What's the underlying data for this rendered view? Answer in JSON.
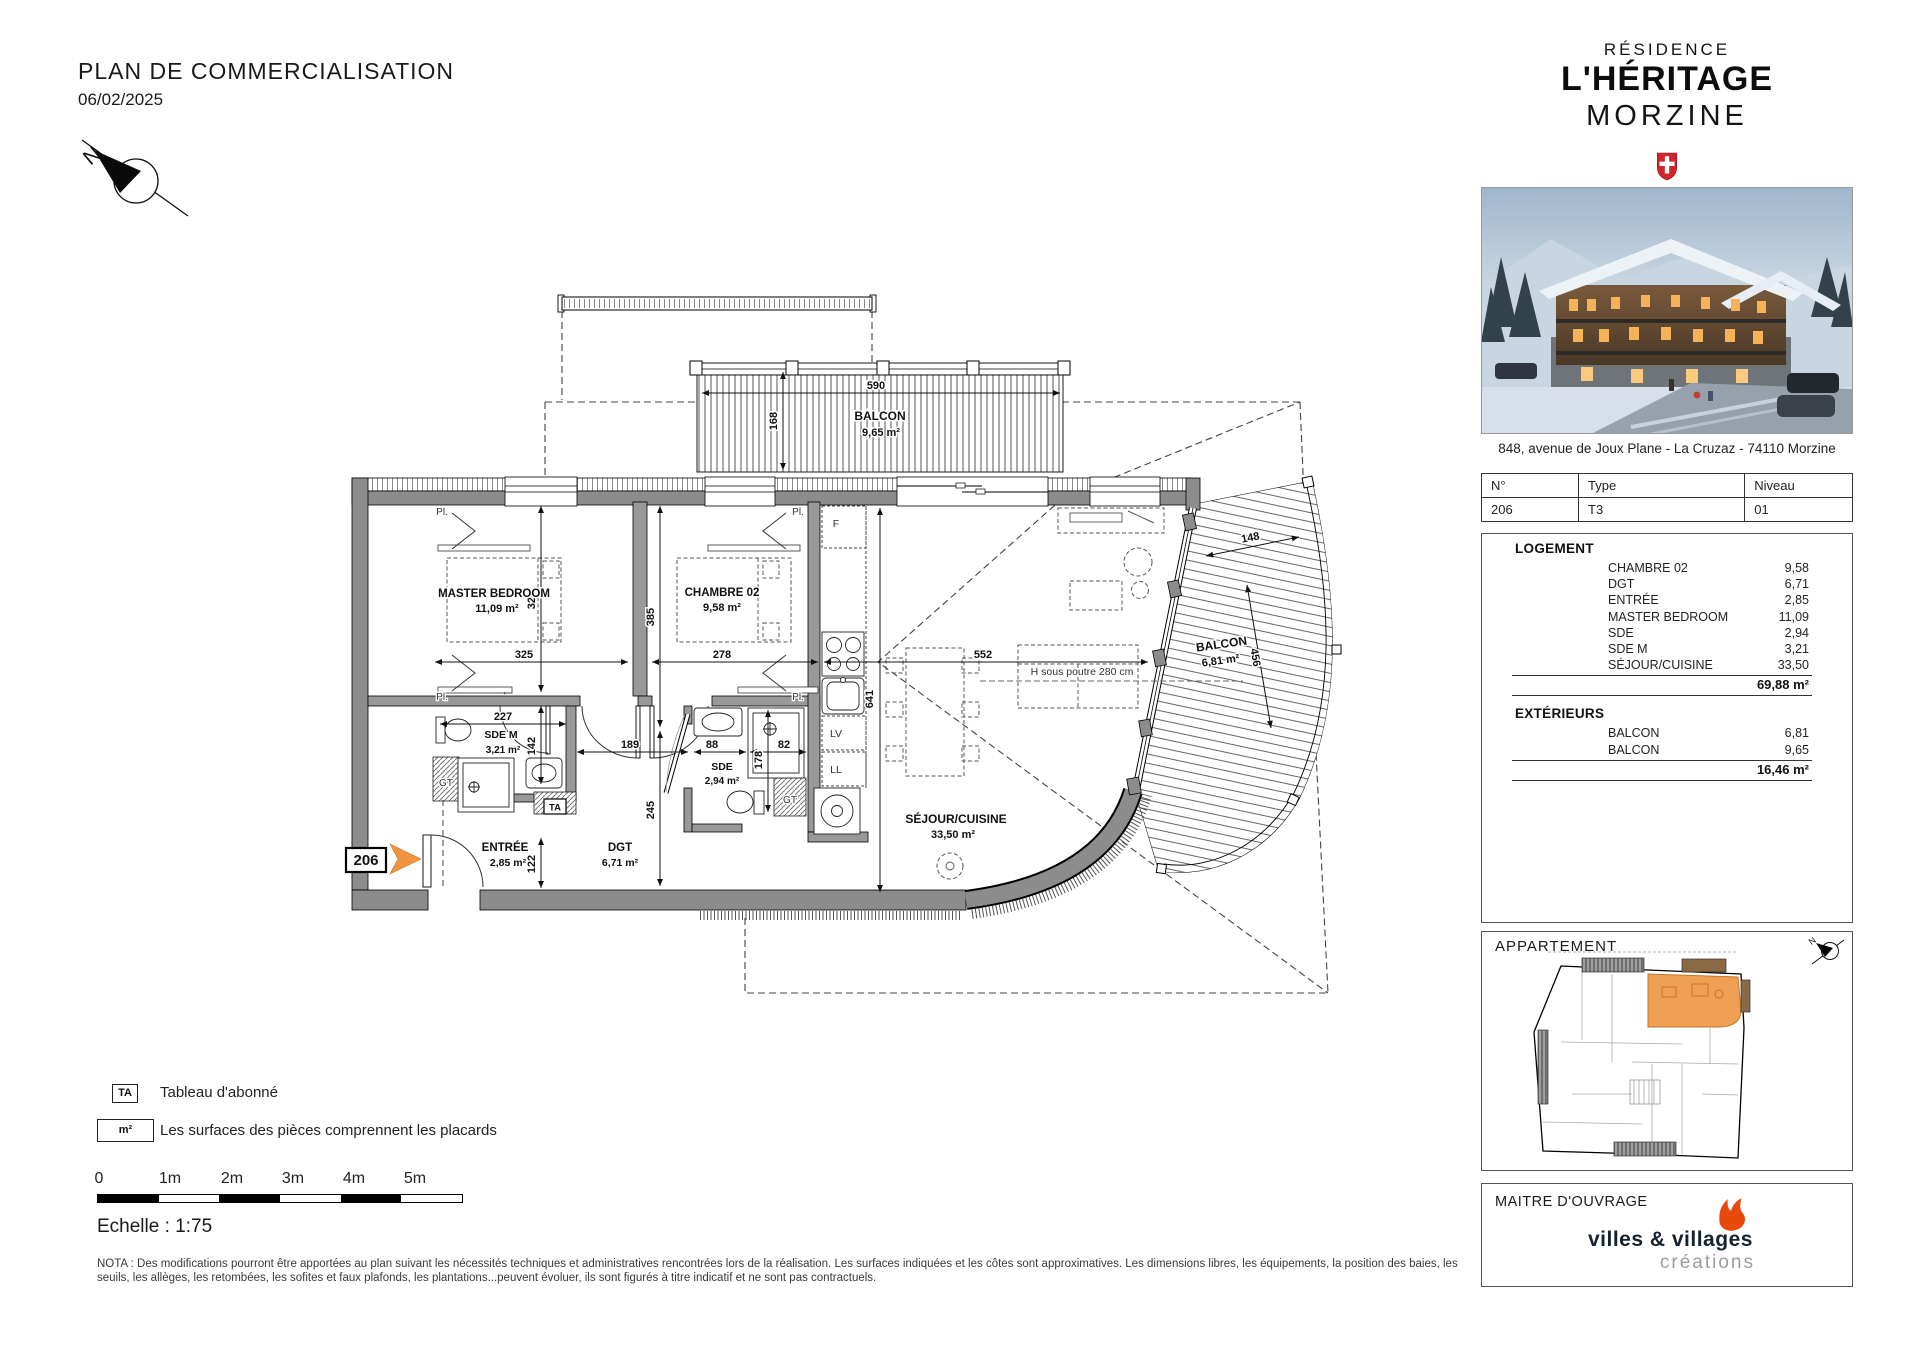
{
  "header": {
    "title": "PLAN DE COMMERCIALISATION",
    "date": "06/02/2025"
  },
  "compass": {
    "north": "N"
  },
  "plan": {
    "marker": "206",
    "balcon_top": {
      "name": "BALCON",
      "area": "9,65 m²"
    },
    "balcon_right": {
      "name": "BALCON",
      "area": "6,81 m²"
    },
    "master": {
      "name": "MASTER BEDROOM",
      "area": "11,09 m²"
    },
    "chambre": {
      "name": "CHAMBRE 02",
      "area": "9,58 m²"
    },
    "sde_m": {
      "name": "SDE M",
      "area": "3,21 m²"
    },
    "sde": {
      "name": "SDE",
      "area": "2,94 m²"
    },
    "entree": {
      "name": "ENTRÉE",
      "area": "2,85 m²"
    },
    "dgt": {
      "name": "DGT",
      "area": "6,71 m²"
    },
    "sejour": {
      "name": "SÉJOUR/CUISINE",
      "area": "33,50 m²"
    },
    "beam_note": "H sous poutre 280 cm",
    "tags": {
      "gt": "GT",
      "ta": "TA",
      "f": "F",
      "lv": "LV",
      "ll": "LL",
      "pl": "Pl."
    },
    "dims": {
      "d590": "590",
      "d168": "168",
      "d325": "325",
      "d278": "278",
      "d552": "552",
      "d385": "385",
      "d245": "245",
      "d320": "320",
      "d142": "142",
      "d122": "122",
      "d227": "227",
      "d189": "189",
      "d88": "88",
      "d82": "82",
      "d178": "178",
      "d641": "641",
      "d148": "148",
      "d456": "456"
    },
    "colors": {
      "accent_orange": "#F0953F",
      "wall_gray": "#8C8C8C"
    }
  },
  "sidebar": {
    "brand": {
      "line1": "RÉSIDENCE",
      "line2": "L'HÉRITAGE",
      "line3": "MORZINE"
    },
    "address": "848, avenue de Joux Plane - La Cruzaz - 74110 Morzine",
    "unit_table": {
      "col1": "N°",
      "col2": "Type",
      "col3": "Niveau",
      "v1": "206",
      "v2": "T3",
      "v3": "01"
    },
    "logement": {
      "title": "LOGEMENT",
      "rows": [
        {
          "label": "CHAMBRE 02",
          "value": "9,58"
        },
        {
          "label": "DGT",
          "value": "6,71"
        },
        {
          "label": "ENTRÉE",
          "value": "2,85"
        },
        {
          "label": "MASTER BEDROOM",
          "value": "11,09"
        },
        {
          "label": "SDE",
          "value": "2,94"
        },
        {
          "label": "SDE M",
          "value": "3,21"
        },
        {
          "label": "SÉJOUR/CUISINE",
          "value": "33,50"
        }
      ],
      "total": "69,88 m²"
    },
    "exterieurs": {
      "title": "EXTÉRIEURS",
      "rows": [
        {
          "label": "BALCON",
          "value": "6,81"
        },
        {
          "label": "BALCON",
          "value": "9,65"
        }
      ],
      "total": "16,46 m²"
    },
    "appartement": {
      "title": "APPARTEMENT"
    },
    "maitre": {
      "title": "MAITRE D'OUVRAGE",
      "brand_name": "villes & villages",
      "brand_sub": "créations"
    }
  },
  "legend": {
    "ta": "TA",
    "ta_text": "Tableau d'abonné",
    "m2": "m²",
    "m2_text": "Les surfaces des pièces comprennent les placards",
    "scale": {
      "t0": "0",
      "t1": "1m",
      "t2": "2m",
      "t3": "3m",
      "t4": "4m",
      "t5": "5m"
    },
    "echelle": "Echelle : 1:75",
    "nota": "NOTA : Des modifications pourront être apportées au plan suivant les nécessités techniques et administratives rencontrées lors de la réalisation. Les surfaces indiquées et les côtes sont approximatives. Les dimensions libres, les équipements, la position des baies, les seuils, les allèges, les retombées, les sofites et faux plafonds, les plantations...peuvent évoluer, ils sont figurés à titre indicatif et ne sont pas contractuels."
  }
}
